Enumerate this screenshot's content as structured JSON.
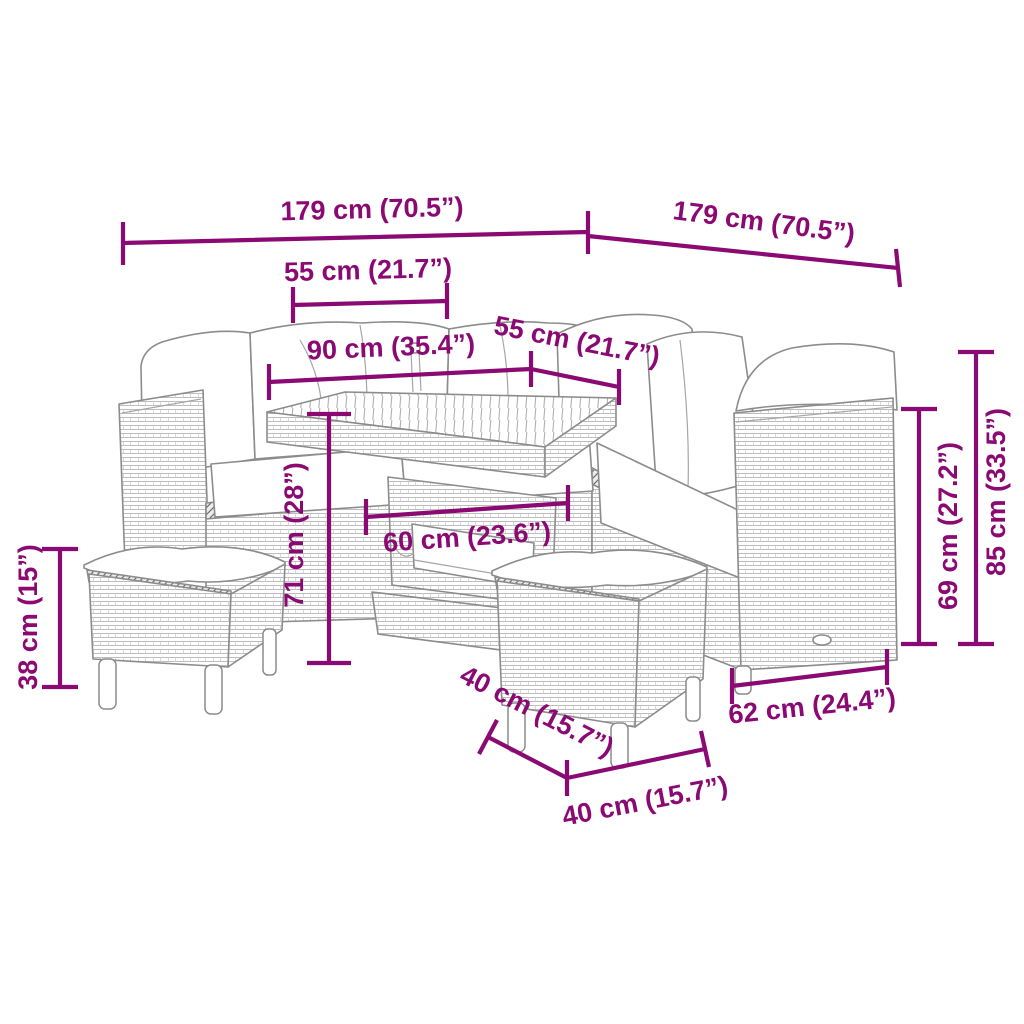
{
  "diagram": {
    "subject": "garden-lounge-set-with-dimensions",
    "pieces": [
      "corner-sofa",
      "dining-table",
      "footstool-left",
      "footstool-right"
    ]
  },
  "colors": {
    "dimension": "#8b0973",
    "line": "#8c8c8c",
    "soft": "#a6a6a6",
    "texture": "#bdbdbd",
    "trim": "#666666"
  },
  "annotations": [
    {
      "id": "overall-width-left",
      "label": "179 cm (70.5”)"
    },
    {
      "id": "overall-width-right",
      "label": "179 cm (70.5”)"
    },
    {
      "id": "back-width-left",
      "label": "55 cm (21.7”)"
    },
    {
      "id": "table-length",
      "label": "90 cm (35.4”)"
    },
    {
      "id": "back-width-right",
      "label": "55 cm (21.7”)"
    },
    {
      "id": "table-height",
      "label": "71 cm (28”)"
    },
    {
      "id": "table-depth",
      "label": "60 cm (23.6”)"
    },
    {
      "id": "stool-height",
      "label": "38 cm (15”)"
    },
    {
      "id": "armrest-height",
      "label": "69 cm (27.2”)"
    },
    {
      "id": "overall-height",
      "label": "85 cm (33.5”)"
    },
    {
      "id": "sofa-depth",
      "label": "62 cm (24.4”)"
    },
    {
      "id": "stool-depth",
      "label": "40 cm (15.7”)"
    },
    {
      "id": "stool-width",
      "label": "40 cm (15.7”)"
    }
  ]
}
